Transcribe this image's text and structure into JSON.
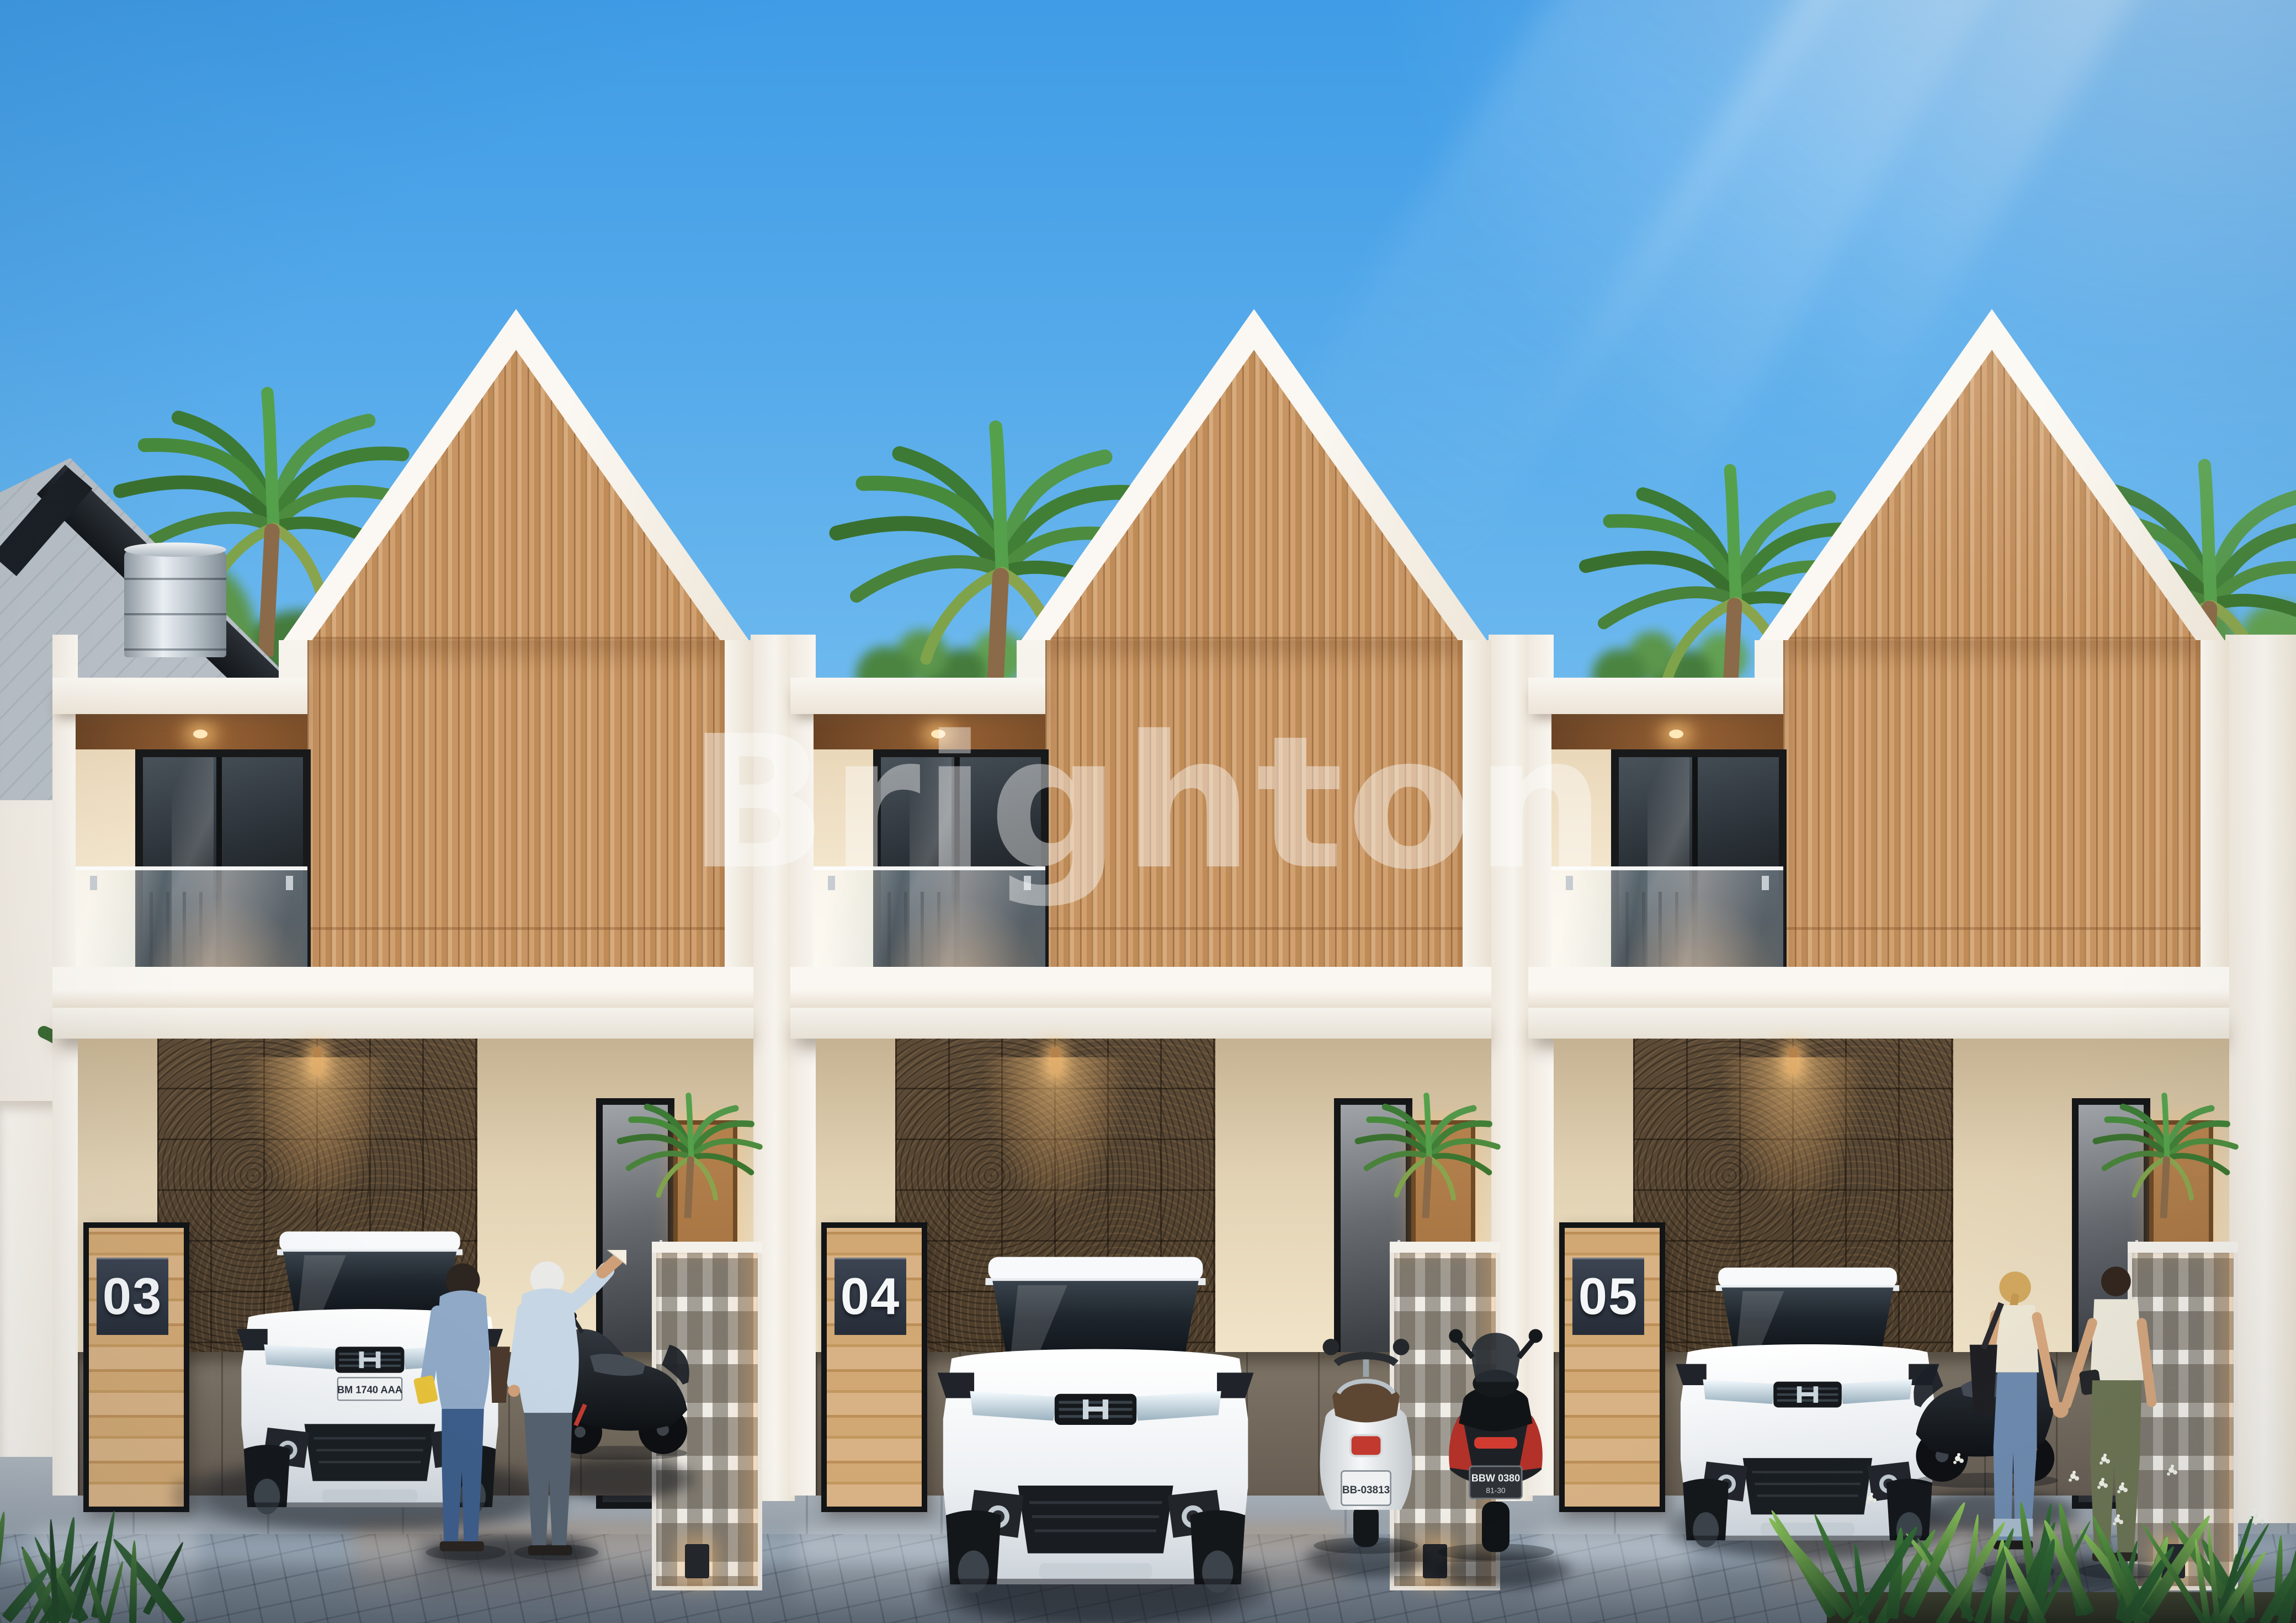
{
  "scene": {
    "watermark": "Brighton",
    "sky_top": "#3f9ce6",
    "sky_horizon": "#cfeafc",
    "accent_wood": "#cf9f6d",
    "accent_stone": "#4e3f30",
    "pavement_wet": "#7c8894",
    "white_wall": "#f6f2ec"
  },
  "houses": [
    {
      "number": "03"
    },
    {
      "number": "04"
    },
    {
      "number": "05"
    }
  ],
  "vehicles": {
    "mpv_front_plate": "BM 1740 AAA",
    "vespa_plate": "BB-03813",
    "scooter_plate": "BBW 0380",
    "scooter_plate_sub": "81-30"
  },
  "people": {
    "left_pair": "elderly-couple-viewing-house",
    "right_pair": "couple-walking-hand-in-hand"
  },
  "wildlife": {
    "birds_count": 14
  }
}
